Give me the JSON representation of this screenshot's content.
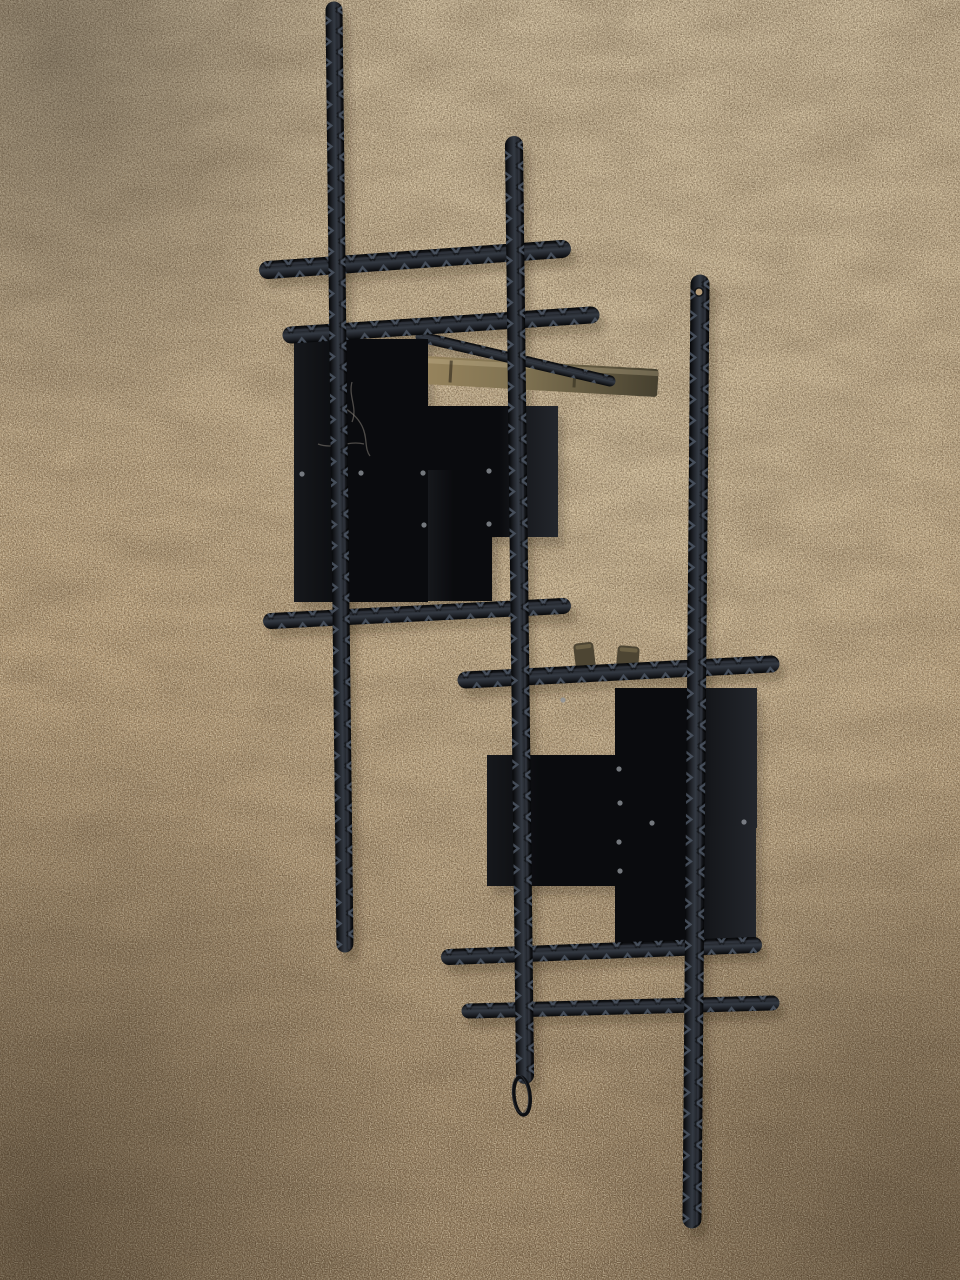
{
  "scene": {
    "alt": "Photograph of a black brutalist welded rebar and steel plate wall sculpture, in two offset grid clusters with a hanging wire loop, lying on tan speckled carpet"
  },
  "colors": {
    "carpet_top": "#c2b092",
    "carpet_mid": "#b69c78",
    "carpet_bottom": "#8b7457",
    "carpet_glow": "#e3d3b2",
    "speckle_dark": "#54432e",
    "speckle_light": "#f2e5c8",
    "mottle_brown": "#5d4b36",
    "rod_black": "#07080a",
    "rod_mid": "#1f2228",
    "rod_core": "#343a43",
    "rod_sheen": "#4e5765",
    "plate_black": "#0a0b0e",
    "plate_soft": "#16181c",
    "plate_charcoal": "#23262c",
    "brass_light": "#97845d",
    "brass_mid": "#7d7050",
    "brass_dark": "#46402f",
    "weld_gray": "#8e949a",
    "wire_black": "#0e0f12"
  },
  "sculpture": {
    "rods": {
      "vertical": [
        {
          "id": "vertical-rod-left",
          "x1": 334,
          "y1": 10,
          "x2": 345,
          "y2": 944,
          "t": 17
        },
        {
          "id": "vertical-rod-middle",
          "x1": 514,
          "y1": 145,
          "x2": 525,
          "y2": 1075,
          "t": 18
        },
        {
          "id": "vertical-rod-right",
          "x1": 700,
          "y1": 284,
          "x2": 692,
          "y2": 1219,
          "t": 19
        }
      ],
      "upper_horizontal": [
        {
          "id": "upper-cross-rod-top",
          "x1": 268,
          "y1": 270,
          "x2": 562,
          "y2": 249,
          "t": 18
        },
        {
          "id": "upper-cross-rod-middle",
          "x1": 291,
          "y1": 335,
          "x2": 591,
          "y2": 315,
          "t": 17
        },
        {
          "id": "upper-cross-rod-bottom",
          "x1": 271,
          "y1": 621,
          "x2": 563,
          "y2": 606,
          "t": 16
        }
      ],
      "lower_horizontal": [
        {
          "id": "lower-cross-rod-top",
          "x1": 466,
          "y1": 680,
          "x2": 771,
          "y2": 664,
          "t": 17
        },
        {
          "id": "lower-cross-rod-middle",
          "x1": 449,
          "y1": 957,
          "x2": 754,
          "y2": 945,
          "t": 16
        },
        {
          "id": "lower-cross-rod-bottom",
          "x1": 469,
          "y1": 1011,
          "x2": 772,
          "y2": 1003,
          "t": 15
        }
      ],
      "diagonal": [
        {
          "id": "diagonal-rod-fragment",
          "x1": 421,
          "y1": 337,
          "x2": 610,
          "y2": 381,
          "t": 11
        }
      ]
    },
    "plates": [
      {
        "id": "upper-plate-large",
        "x": 294,
        "y": 339,
        "w": 134,
        "h": 263,
        "tone": "black"
      },
      {
        "id": "upper-plate-right",
        "x": 428,
        "y": 406,
        "w": 130,
        "h": 131,
        "tone": "charcoal"
      },
      {
        "id": "upper-plate-lower",
        "x": 428,
        "y": 470,
        "w": 64,
        "h": 131,
        "tone": "black"
      },
      {
        "id": "lower-plate-top",
        "x": 615,
        "y": 688,
        "w": 142,
        "h": 140,
        "tone": "charcoal"
      },
      {
        "id": "lower-plate-left",
        "x": 487,
        "y": 755,
        "w": 132,
        "h": 131,
        "tone": "black"
      },
      {
        "id": "lower-plate-bottom",
        "x": 615,
        "y": 826,
        "w": 141,
        "h": 117,
        "tone": "charcoal"
      }
    ],
    "accents": {
      "brass_bar": {
        "x": 424,
        "y": 356,
        "w": 235,
        "h": 28,
        "angle": 3.2
      },
      "stubs": [
        {
          "x": 573,
          "y": 644,
          "w": 20,
          "h": 26,
          "rot": -7
        },
        {
          "x": 618,
          "y": 645,
          "w": 22,
          "h": 23,
          "rot": 5
        }
      ],
      "weld_dots": [
        [
          302,
          474
        ],
        [
          361,
          473
        ],
        [
          423,
          473
        ],
        [
          424,
          525
        ],
        [
          489,
          471
        ],
        [
          489,
          524
        ],
        [
          619,
          769
        ],
        [
          620,
          803
        ],
        [
          619,
          842
        ],
        [
          620,
          871
        ],
        [
          652,
          823
        ],
        [
          744,
          822
        ],
        [
          563,
          700
        ]
      ],
      "scratches": [
        "M332,396 c8,12 22,14 30,30 c6,12 2,22 8,30",
        "M352,382 c-4,14 6,26 0,40",
        "M318,444 c16,6 30,-4 46,0"
      ],
      "hole": {
        "x": 699,
        "y": 292,
        "r": 3.4
      },
      "wire_loop": {
        "cx": 522,
        "cy": 1096,
        "rx": 8,
        "ry": 19
      }
    }
  }
}
